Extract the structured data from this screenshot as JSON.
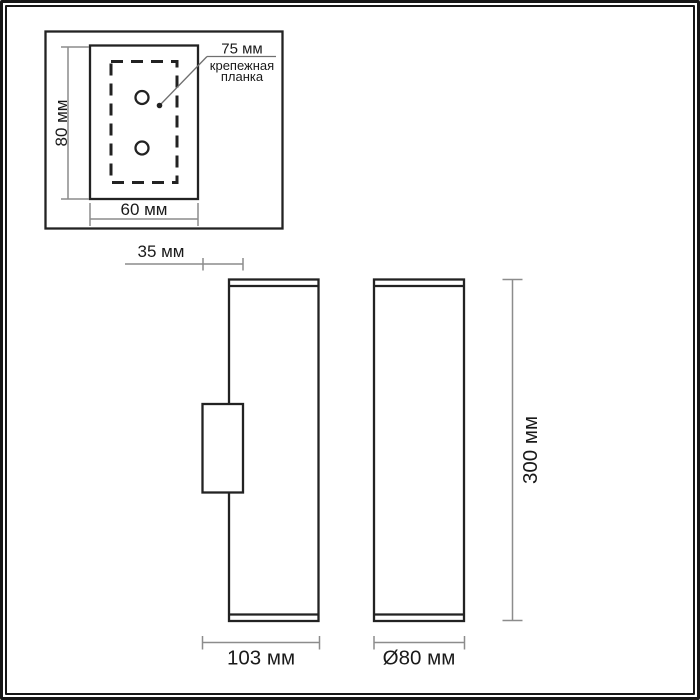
{
  "colors": {
    "background": "#ffffff",
    "frame": "#161616",
    "outline": "#222222",
    "dimension": "#8c8c8c",
    "leader": "#6f6f6f",
    "text": "#1a1a1a"
  },
  "detail_view": {
    "height_label": "80 мм",
    "width_label": "60 мм",
    "plate_size_label": "75 мм",
    "plate_caption_line1": "крепежная",
    "plate_caption_line2": "планка"
  },
  "side_view": {
    "bracket_depth_label": "35 мм",
    "total_depth_label": "103 мм"
  },
  "front_view": {
    "height_label": "300 мм",
    "diameter_label": "Ø80 мм"
  }
}
